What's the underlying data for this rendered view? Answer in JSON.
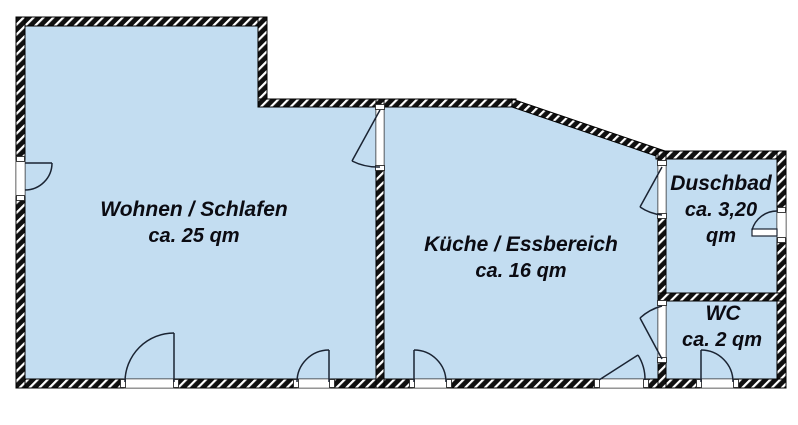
{
  "plan": {
    "type": "floor-plan",
    "rooms": {
      "wohnen": {
        "label": "Wohnen / Schlafen",
        "area": "ca. 25 qm"
      },
      "kueche": {
        "label": "Küche / Essbereich",
        "area": "ca. 16 qm"
      },
      "duschbad": {
        "label": "Duschbad",
        "area_l1": "ca. 3,20",
        "area_l2": "qm"
      },
      "wc": {
        "label": "WC",
        "area": "ca. 2 qm"
      }
    },
    "colors": {
      "room_fill": "#C3DDF1",
      "wall_hatch_dark": "#101010",
      "wall_hatch_light": "#FFFFFF",
      "label_text": "#0B0B12",
      "door_line": "#1A2332",
      "background": "#FFFFFF"
    }
  }
}
